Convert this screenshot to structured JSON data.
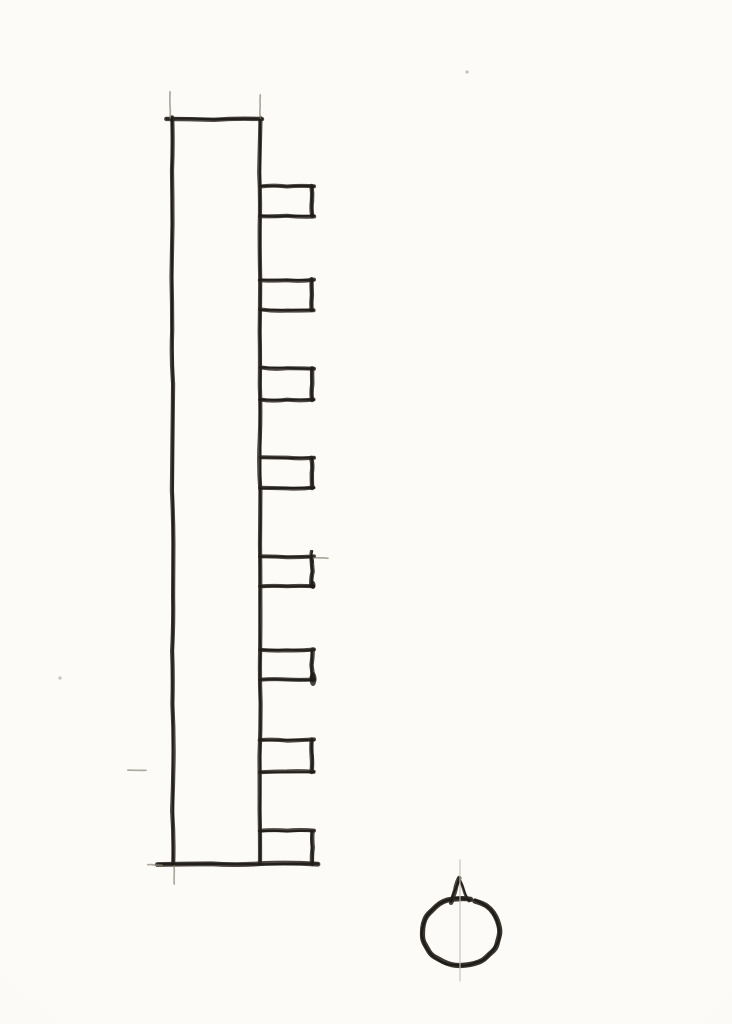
{
  "page": {
    "kind": "scanned hand-drawn pencil sketch on paper",
    "paper_color": "#fbfaf6",
    "paper_shade_color": "#f0eee7"
  },
  "sketch": {
    "canvas": {
      "width": 732,
      "height": 1024
    },
    "stroke_color": "#2b2621",
    "ink_color": "#1e1a15",
    "faint_color": "#8d8678",
    "guide_color": "#c6c1b5",
    "speck_color": "#b9b3a8",
    "toothed_bar": {
      "left_x": 172,
      "right_x": 260,
      "top_y": 119,
      "bottom_y": 864,
      "top_line": {
        "x1": 166,
        "x2": 262,
        "y": 119
      },
      "bottom_line": {
        "x1": 158,
        "x2": 318,
        "y": 864
      },
      "teeth_right_x": 312,
      "teeth": [
        {
          "top_y": 186,
          "bottom_y": 216
        },
        {
          "top_y": 280,
          "bottom_y": 310
        },
        {
          "top_y": 368,
          "bottom_y": 400
        },
        {
          "top_y": 458,
          "bottom_y": 488
        },
        {
          "top_y": 557,
          "bottom_y": 586
        },
        {
          "top_y": 650,
          "bottom_y": 680
        },
        {
          "top_y": 740,
          "bottom_y": 772
        },
        {
          "top_y": 831,
          "bottom_y": 864
        }
      ]
    },
    "pointer_symbol": {
      "circle": {
        "cx": 461,
        "cy": 932,
        "rx": 39,
        "ry": 34
      },
      "triangle": {
        "apex": [
          459,
          878
        ],
        "base_left": [
          451,
          902
        ],
        "base_right": [
          469,
          901
        ]
      },
      "axis_line": {
        "x": 460,
        "y1": 860,
        "y2": 981
      }
    },
    "construction_marks": [
      {
        "type": "v",
        "x": 170,
        "y1": 92,
        "y2": 118
      },
      {
        "type": "v",
        "x": 260,
        "y1": 95,
        "y2": 118
      },
      {
        "type": "v",
        "x": 174,
        "y1": 866,
        "y2": 884
      },
      {
        "type": "h",
        "x1": 148,
        "x2": 162,
        "y": 865
      },
      {
        "type": "h",
        "x1": 312,
        "x2": 328,
        "y": 558
      },
      {
        "type": "h",
        "x1": 128,
        "x2": 146,
        "y": 770
      }
    ],
    "extra_strokes": [
      {
        "x1": 312,
        "y1": 551,
        "x2": 312,
        "y2": 562
      }
    ],
    "ink_blobs": [
      {
        "x": 313,
        "y": 679,
        "rx": 3.5,
        "ry": 7
      },
      {
        "x": 313,
        "y": 585,
        "rx": 2.5,
        "ry": 4
      }
    ],
    "specks": [
      {
        "x": 467,
        "y": 72
      },
      {
        "x": 60,
        "y": 678
      }
    ]
  }
}
